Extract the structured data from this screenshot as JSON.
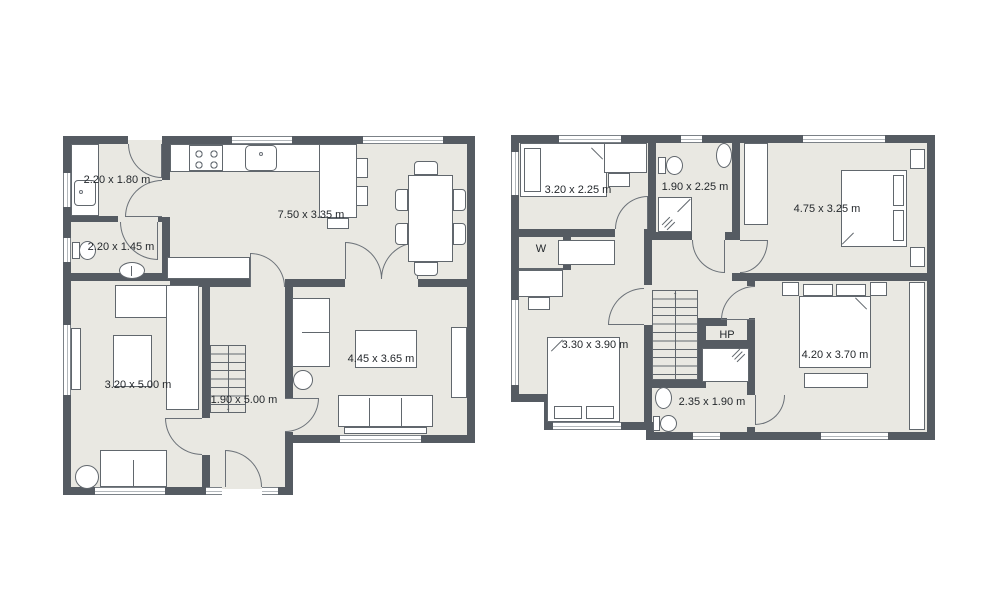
{
  "colors": {
    "background": "#ffffff",
    "wall": "#555b62",
    "floor": "#e9e8e2",
    "furniture": "#ffffff",
    "outline": "#61676d",
    "text": "#24282c"
  },
  "icons": {
    "stairs_down_arrow": "↓",
    "stairs_up_arrow": "↑"
  },
  "plans": [
    {
      "id": "ground-floor",
      "rooms": [
        {
          "id": "utility",
          "label": "2.20 x 1.80 m"
        },
        {
          "id": "wc",
          "label": "2.20 x 1.45 m"
        },
        {
          "id": "kitchen-diner",
          "label": "7.50 x 3.35 m"
        },
        {
          "id": "living-room",
          "label": "3.20 x 5.00 m"
        },
        {
          "id": "hallway",
          "label": "1.90 x 5.00 m"
        },
        {
          "id": "family-room",
          "label": "4.45 x 3.65 m"
        }
      ]
    },
    {
      "id": "first-floor",
      "rooms": [
        {
          "id": "bedroom-1",
          "label": "3.20 x 2.25 m"
        },
        {
          "id": "bathroom",
          "label": "1.90 x 2.25 m"
        },
        {
          "id": "master-bedroom",
          "label": "4.75 x 3.25 m"
        },
        {
          "id": "wardrobe",
          "label": "W"
        },
        {
          "id": "bedroom-2",
          "label": "3.30 x 3.90 m"
        },
        {
          "id": "hot-press",
          "label": "HP"
        },
        {
          "id": "shower-room",
          "label": "2.35 x 1.90 m"
        },
        {
          "id": "bedroom-3",
          "label": "4.20 x 3.70 m"
        }
      ]
    }
  ]
}
